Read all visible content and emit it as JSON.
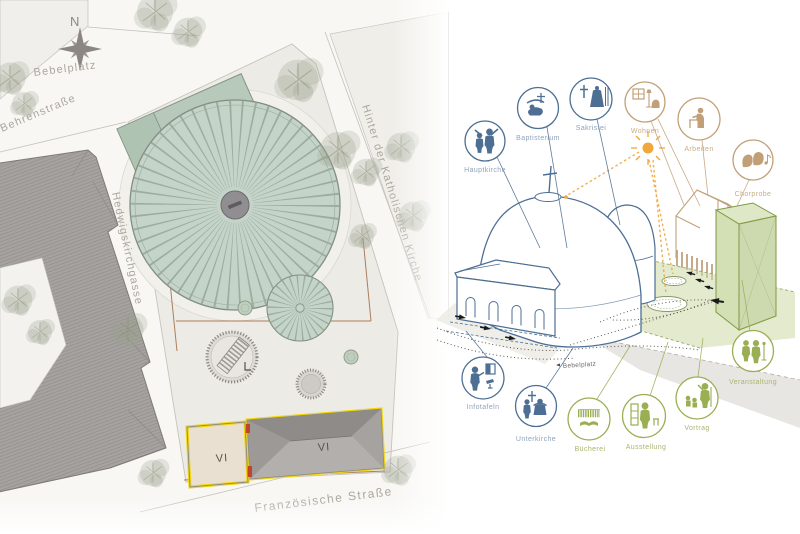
{
  "plan": {
    "compass": {
      "letter": "N",
      "icon": "compass-rose-icon"
    },
    "streets": {
      "bebelplatz": "Bebelplatz",
      "behrenstrasse": "Behrenstraße",
      "hedwigskirchgasse": "Hedwigskirchgasse",
      "hinter_der_katholischen_kirche": "Hinter der Katholischen Kirche",
      "franzoesische_strasse": "Französische Straße"
    },
    "buildings": [
      {
        "label": "VI"
      },
      {
        "label": "VI"
      }
    ],
    "colors": {
      "dome_fill": "#c5d4c9",
      "dome_spokes": "#8da092",
      "roof_gray": "#a09d9a",
      "highlight_yellow": "#f2d70a",
      "parcel_line_brown": "#a06b45",
      "label_gray": "#aba79e"
    }
  },
  "diagram": {
    "plaza_label": "Bebelplatz",
    "icons": [
      {
        "id": "hauptkirche",
        "label": "Hauptkirche",
        "color": "#4d6f94",
        "glyph": "preacher-and-listener-icon"
      },
      {
        "id": "baptisterium",
        "label": "Baptisterium",
        "color": "#4d6f94",
        "glyph": "baptism-icon"
      },
      {
        "id": "sakristei",
        "label": "Sakristei",
        "color": "#4d6f94",
        "glyph": "cross-and-vestment-icon"
      },
      {
        "id": "wohnen",
        "label": "Wohnen",
        "color": "#c1a077",
        "glyph": "window-lamp-armchair-icon"
      },
      {
        "id": "arbeiten",
        "label": "Arbeiten",
        "color": "#c1a077",
        "glyph": "person-at-desk-icon"
      },
      {
        "id": "chorprobe",
        "label": "Chorprobe",
        "color": "#c1a077",
        "glyph": "singing-heads-notes-icon"
      },
      {
        "id": "veranstaltung",
        "label": "Veranstaltung",
        "color": "#9aae52",
        "glyph": "performers-microphone-icon"
      },
      {
        "id": "vortrag",
        "label": "Vortrag",
        "color": "#9aae52",
        "glyph": "lecturer-audience-icon"
      },
      {
        "id": "ausstellung",
        "label": "Ausstellung",
        "color": "#9aae52",
        "glyph": "visitor-exhibit-icon"
      },
      {
        "id": "buecherei",
        "label": "Bücherei",
        "color": "#9aae52",
        "glyph": "bookshelf-open-book-icon"
      },
      {
        "id": "unterkirche",
        "label": "Unterkirche",
        "color": "#4d6f94",
        "glyph": "cross-and-figures-icon"
      },
      {
        "id": "infotafeln",
        "label": "Infotafeln",
        "color": "#4d6f94",
        "glyph": "person-info-panel-icon"
      }
    ],
    "colors": {
      "church_line_blue": "#4d6f94",
      "house_line_tan": "#c1a077",
      "event_green": "#9aae52",
      "sun_orange": "#f0a73c",
      "plaza_green": "#cdd8a4"
    }
  }
}
